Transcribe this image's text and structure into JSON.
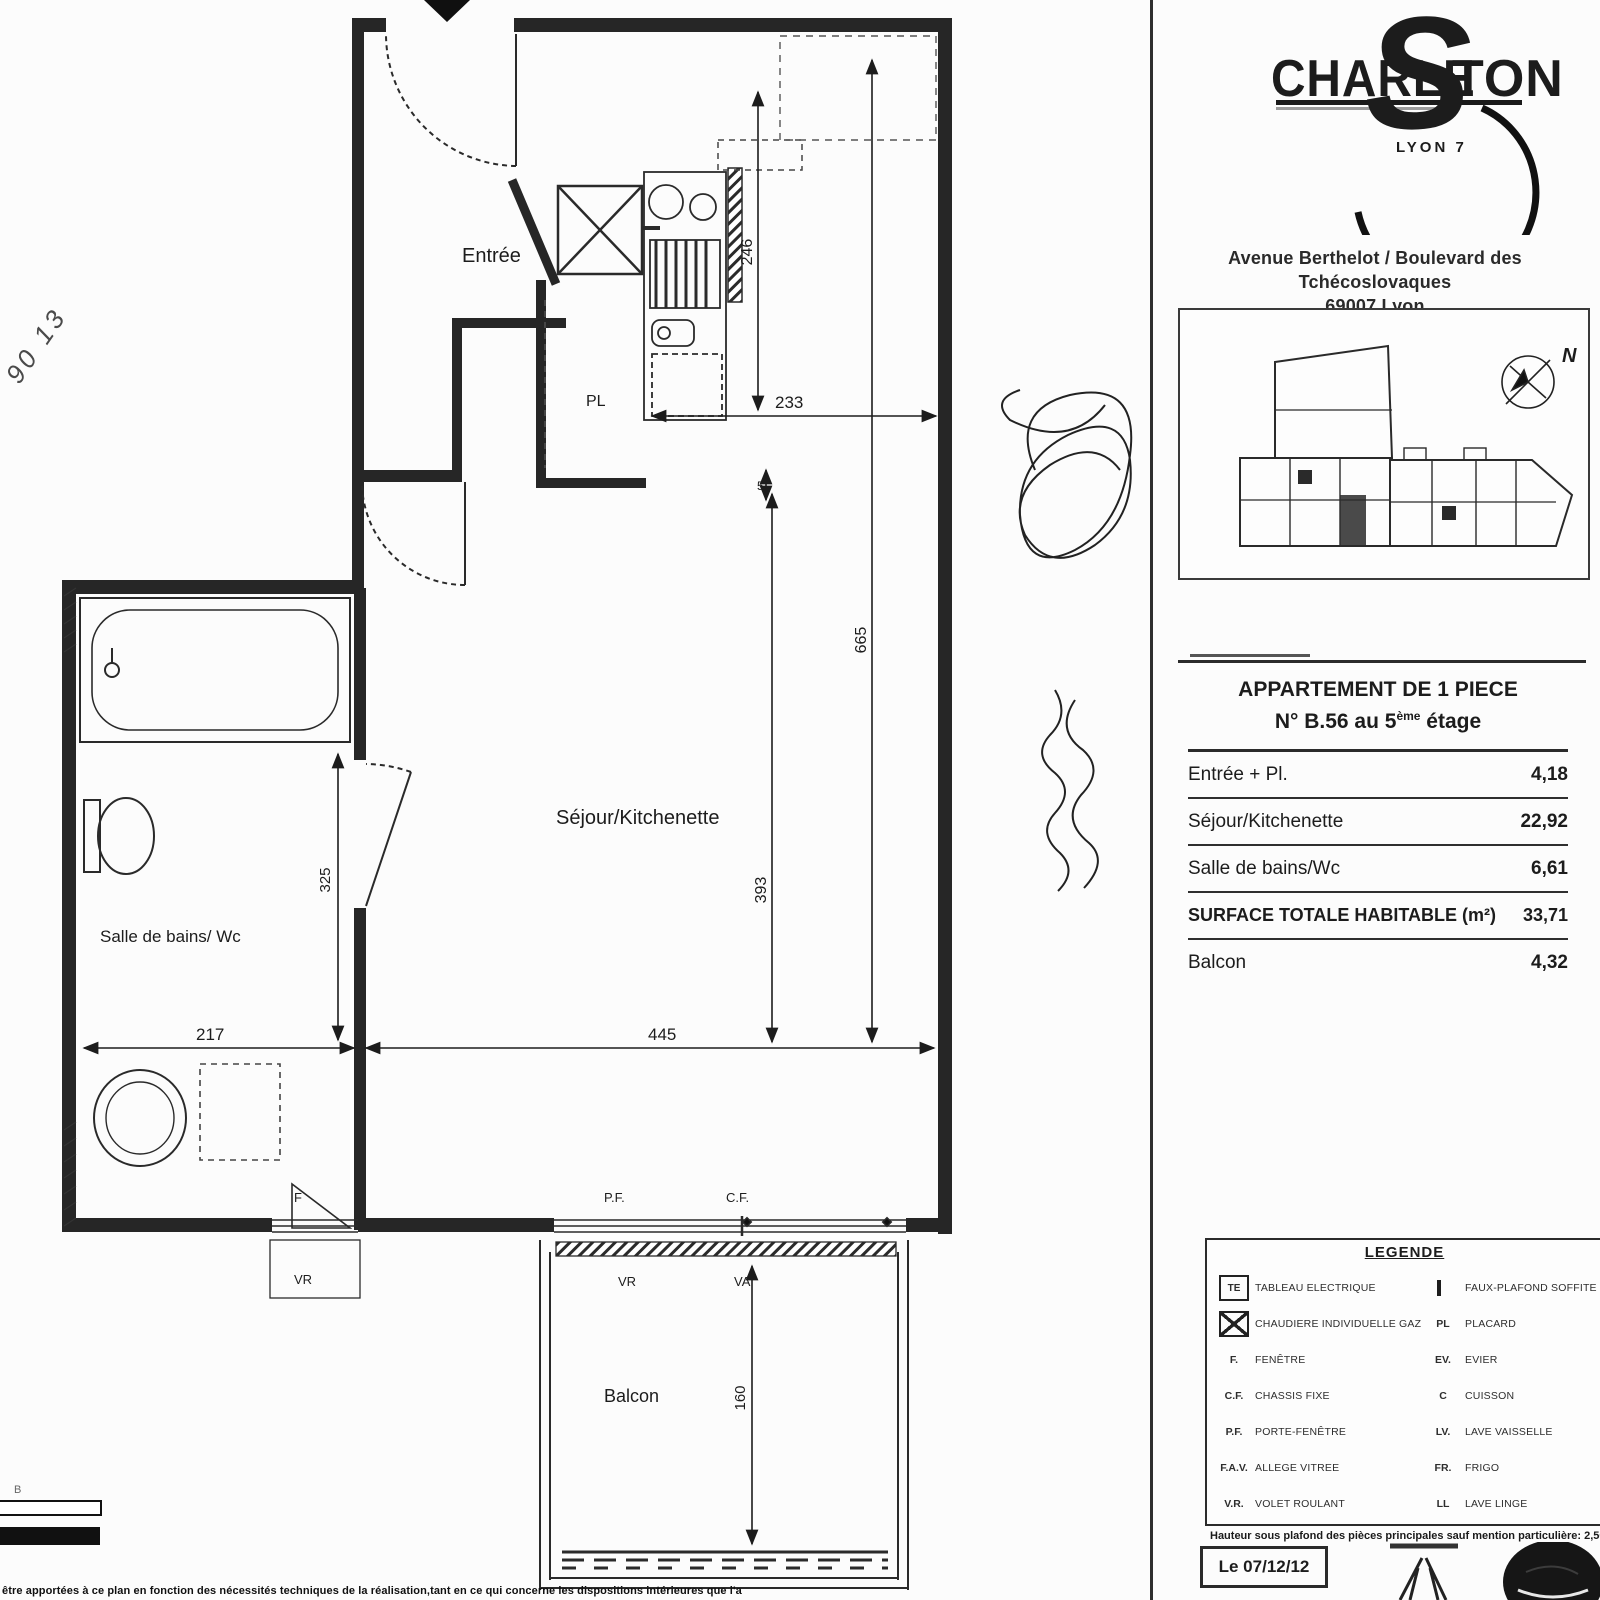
{
  "logo": {
    "part1": "CHARLE",
    "part2": "S",
    "part3": "TON",
    "subtitle": "LYON 7"
  },
  "address": {
    "line1": "Avenue Berthelot / Boulevard des Tchécoslovaques",
    "line2": "69007 Lyon"
  },
  "site_plan": {
    "north_label": "N"
  },
  "apartment_table": {
    "title_line1": "APPARTEMENT DE 1 PIECE",
    "title_line2_pre": "N° B.56 au 5",
    "title_line2_sup": "ème",
    "title_line2_post": " étage",
    "rows": [
      {
        "label": "Entrée + Pl.",
        "value": "4,18"
      },
      {
        "label": "Séjour/Kitchenette",
        "value": "22,92"
      },
      {
        "label": "Salle de bains/Wc",
        "value": "6,61"
      },
      {
        "label": "SURFACE TOTALE HABITABLE (m²)",
        "value": "33,71"
      },
      {
        "label": "Balcon",
        "value": "4,32"
      }
    ]
  },
  "legend": {
    "title": "LEGENDE",
    "left": [
      {
        "key": "TE",
        "label": "TABLEAU ELECTRIQUE",
        "icon": "te-box-icon"
      },
      {
        "key": "X",
        "label": "CHAUDIERE INDIVIDUELLE GAZ",
        "icon": "boiler-x-icon"
      },
      {
        "key": "F.",
        "label": "FENÊTRE"
      },
      {
        "key": "C.F.",
        "label": "CHASSIS FIXE"
      },
      {
        "key": "P.F.",
        "label": "PORTE-FENÊTRE"
      },
      {
        "key": "F.A.V.",
        "label": "ALLEGE VITREE"
      },
      {
        "key": "V.R.",
        "label": "VOLET ROULANT"
      }
    ],
    "right": [
      {
        "key": "",
        "label": "FAUX-PLAFOND SOFFITE",
        "icon": "hatch-swatch"
      },
      {
        "key": "PL",
        "label": "PLACARD"
      },
      {
        "key": "EV.",
        "label": "EVIER"
      },
      {
        "key": "C",
        "label": "CUISSON"
      },
      {
        "key": "LV.",
        "label": "LAVE VAISSELLE"
      },
      {
        "key": "FR.",
        "label": "FRIGO"
      },
      {
        "key": "LL",
        "label": "LAVE LINGE"
      }
    ],
    "footnote": "Hauteur sous plafond des pièces principales sauf mention particulière: 2,50 m"
  },
  "date_box": {
    "label": "Le 07/12/12"
  },
  "plan": {
    "rooms": {
      "entree": "Entrée",
      "closet": "PL",
      "sejour": "Séjour/Kitchenette",
      "bath": "Salle de bains/ Wc",
      "balcony": "Balcon"
    },
    "dims": {
      "kitchen_width": "233",
      "kitchen_depth": "246",
      "living_depth": "393",
      "total_depth": "665",
      "living_width": "445",
      "bath_width": "217",
      "bath_inner": "325",
      "balcony_depth": "160",
      "wall": "5"
    },
    "openings": {
      "bath_window": "F",
      "bath_shutter": "VR",
      "door_window": "P.F.",
      "fixed_frame": "C.F.",
      "shutter": "VR",
      "glazed_sill": "VA"
    }
  },
  "annotations": {
    "handwritten_note": "90 13"
  },
  "scale_bar": {
    "label": "B"
  },
  "disclaimer": "être apportées à ce plan en fonction des nécessités techniques de la réalisation,tant en ce qui concerne les dispositions intérieures que l'aménagement.",
  "colors": {
    "ink": "#1c1c1c",
    "paper": "#fcfcfc"
  }
}
